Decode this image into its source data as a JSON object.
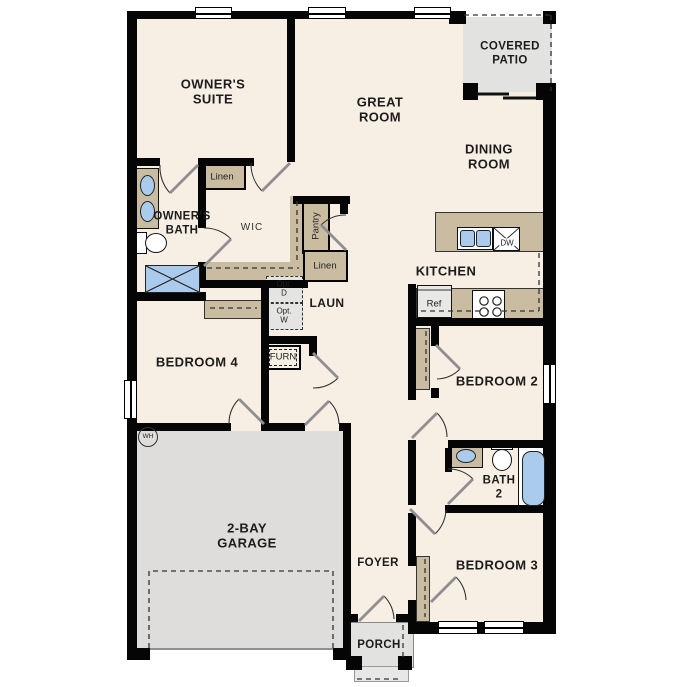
{
  "palette": {
    "wall": "#050505",
    "floor": "#f8efe4",
    "closet_tan": "#c9bca0",
    "outdoor_gray": "#e2e2e0",
    "fixture_blue": "#abcbec"
  },
  "rooms": {
    "owners_suite": {
      "line1": "OWNER'S",
      "line2": "SUITE"
    },
    "great_room": {
      "line1": "GREAT",
      "line2": "ROOM"
    },
    "covered_patio": {
      "line1": "COVERED",
      "line2": "PATIO"
    },
    "dining_room": {
      "line1": "DINING",
      "line2": "ROOM"
    },
    "kitchen": {
      "label": "KITCHEN"
    },
    "owners_bath": {
      "line1": "OWNER'S",
      "line2": "BATH"
    },
    "wic": {
      "label": "WIC"
    },
    "laundry": {
      "label": "LAUN"
    },
    "bedroom4": {
      "label": "BEDROOM 4"
    },
    "bedroom2": {
      "label": "BEDROOM 2"
    },
    "bath2": {
      "line1": "BATH",
      "line2": "2"
    },
    "bedroom3": {
      "label": "BEDROOM 3"
    },
    "foyer": {
      "label": "FOYER"
    },
    "garage": {
      "line1": "2-BAY",
      "line2": "GARAGE"
    },
    "porch": {
      "label": "PORCH"
    }
  },
  "closets": {
    "linen_wic": "Linen",
    "pantry": "Pantry",
    "linen_hall": "Linen"
  },
  "appliances": {
    "dryer_opt": {
      "line1": "Opt.",
      "line2": "D"
    },
    "washer_opt": {
      "line1": "Opt.",
      "line2": "W"
    },
    "furnace": "FURN",
    "water_heater": "WH",
    "refrigerator": "Ref",
    "dishwasher": "DW"
  }
}
